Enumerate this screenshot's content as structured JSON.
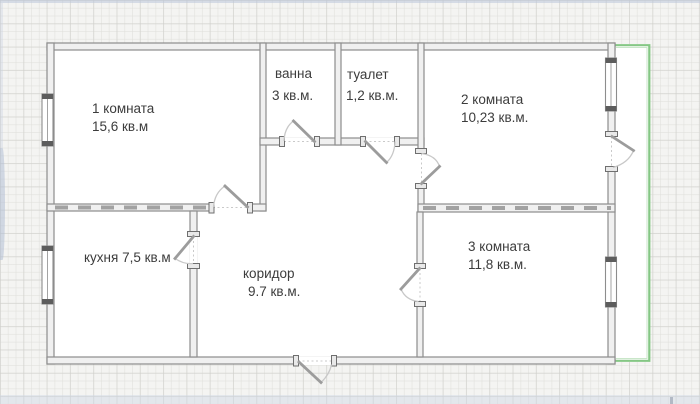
{
  "rooms": {
    "room1": {
      "label": "1 комната",
      "area": "15,6 кв.м"
    },
    "bath": {
      "label": "ванна",
      "area": "3 кв.м."
    },
    "toilet": {
      "label": "туалет",
      "area": "1,2 кв.м."
    },
    "room2": {
      "label": "2 комната",
      "area": "10,23 кв.м."
    },
    "kitchen": {
      "label": "кухня 7,5 кв.м"
    },
    "corridor": {
      "label": "коридор",
      "area": "9.7 кв.м."
    },
    "room3": {
      "label": "3 комната",
      "area": "11,8 кв.м."
    }
  },
  "colors": {
    "wall_stroke": "#8d8d8d",
    "wall_fill": "#f0f0f0",
    "balcony_outline": "#85c785",
    "label_text": "#3c3c3c",
    "canvas_bg": "#f4f4f2",
    "watermark": "#b3c0d6"
  }
}
